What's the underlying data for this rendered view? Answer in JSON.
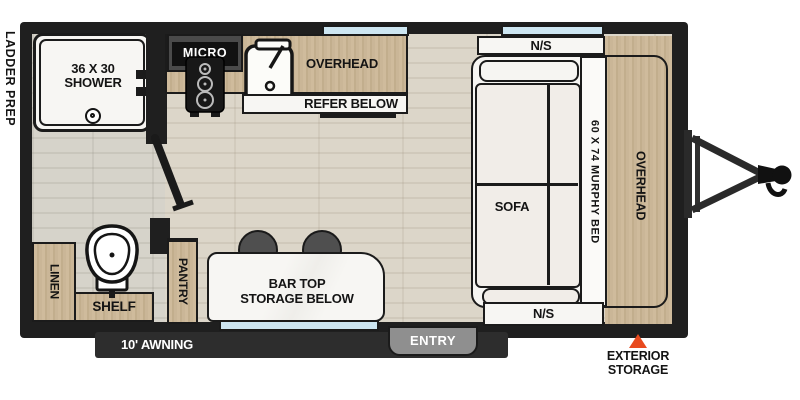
{
  "colors": {
    "wall": "#1f1f1f",
    "floor_main": "#d8d2c5",
    "floor_bath": "#d0cdc3",
    "cabinet_wood": "#c8b493",
    "window_blue": "#cde6f2",
    "counter_marble": "#f6f5f2",
    "cushion_white": "#f1ede8",
    "stool_gray": "#4f4f4f",
    "entry_gray": "#8f8f8f",
    "awning_bar": "#2d2d2d",
    "accent_red": "#e84a1e"
  },
  "exterior": {
    "ladder_prep": "LADDER PREP",
    "awning": "10' AWNING",
    "entry": "ENTRY",
    "exterior_storage_1": "EXTERIOR",
    "exterior_storage_2": "STORAGE"
  },
  "bathroom": {
    "shower_size": "36 X 30",
    "shower": "SHOWER",
    "linen": "LINEN",
    "shelf": "SHELF"
  },
  "kitchen": {
    "micro": "MICRO",
    "overhead": "OVERHEAD",
    "refer": "REFER BELOW",
    "pantry": "PANTRY",
    "bar_top_1": "BAR TOP",
    "bar_top_2": "STORAGE BELOW"
  },
  "bedroom": {
    "ns_top": "N/S",
    "ns_bottom": "N/S",
    "murphy": "60 X 74 MURPHY BED",
    "overhead": "OVERHEAD",
    "sofa": "SOFA"
  }
}
